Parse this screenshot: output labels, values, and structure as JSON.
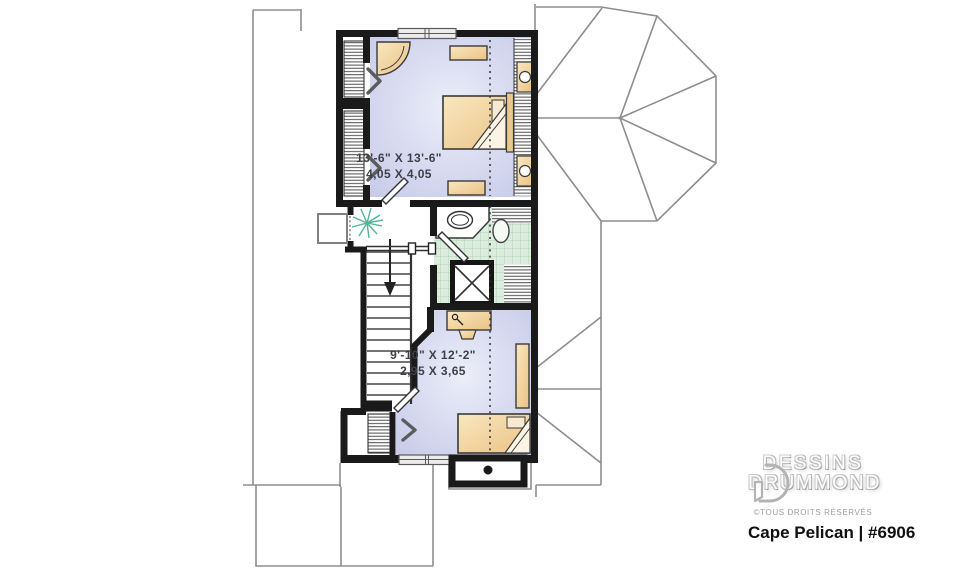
{
  "document": {
    "type": "second-floor-plan"
  },
  "rooms": {
    "bedroom1": {
      "dim_imperial": "13'-6\" X 13'-6\"",
      "dim_metric": "4,05 X 4,05"
    },
    "bedroom2": {
      "dim_imperial": "9'-10\" X 12'-2\"",
      "dim_metric": "2,95 X 3,65"
    }
  },
  "branding": {
    "name_line1": "DESSINS",
    "name_line2": "DRUMMOND",
    "rights": "©TOUS DROITS RÉSERVÉS",
    "plan_title": "Cape Pelican | #6906"
  },
  "icons": [
    "stair-down-arrow",
    "plant",
    "attic-access-chevron",
    "chimney-flue-dot",
    "drummond-logo-mark"
  ],
  "colors": {
    "wall": "#1a1a1a",
    "roofline": "#8d8d8d",
    "floor-edge": "#c7cce8",
    "floor-center": "#eceef8",
    "tile": "#dcecdd",
    "tile-grid": "#b2d3b6",
    "furniture": "#f2d8a1",
    "furniture-deep": "#ecc184",
    "plant": "#53b395",
    "dim-text": "#3f3f49",
    "title-text": "#101010"
  }
}
